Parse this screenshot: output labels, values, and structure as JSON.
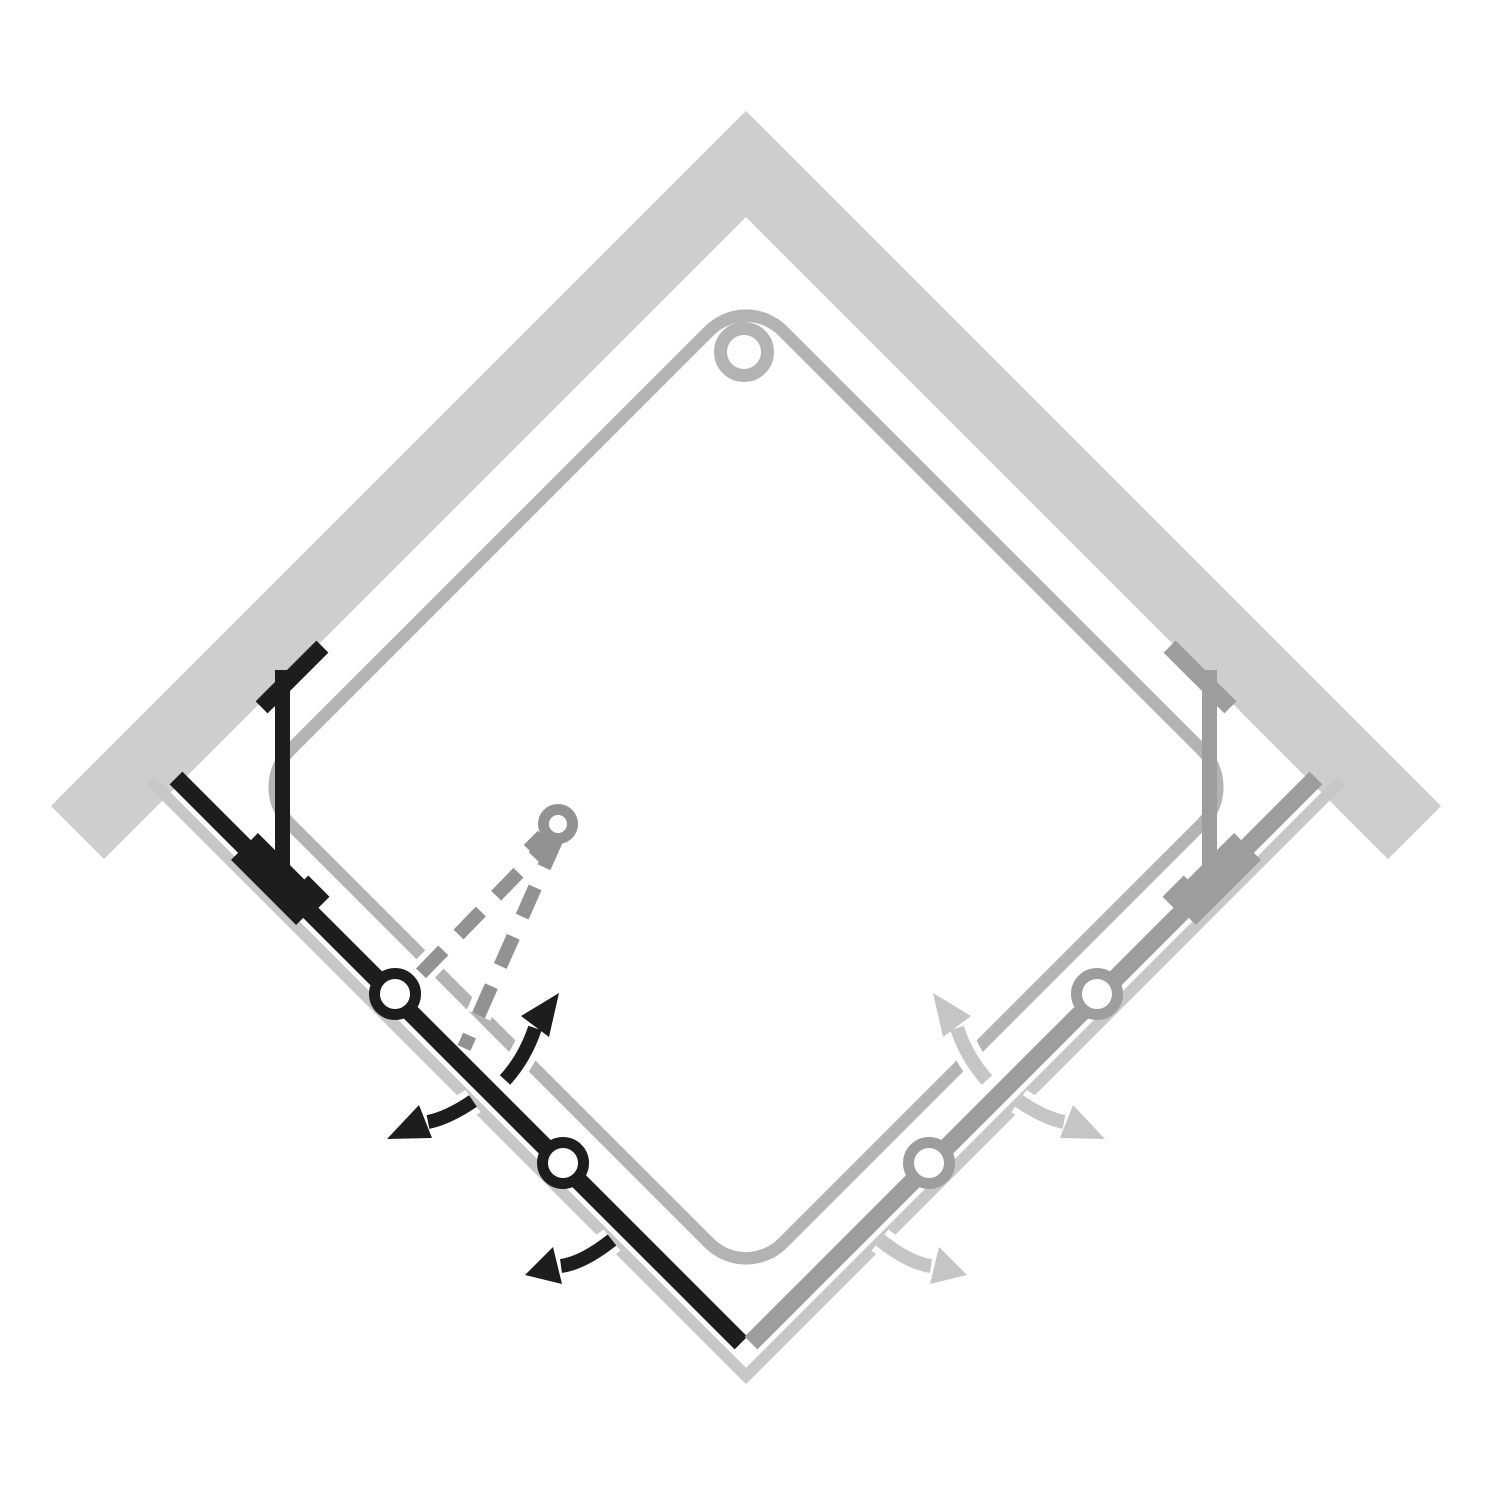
{
  "canvas": {
    "background": "#ffffff",
    "width_px": 1500,
    "height_px": 1500
  },
  "colors": {
    "background": "#ffffff",
    "wall": "#cecece",
    "tray_rim": "#b3b3b3",
    "tray_outer_edge": "#c7c7c7",
    "drain_ring": "#b3b3b3",
    "active_door": "#1d1d1b",
    "inactive_door": "#9d9d9d",
    "inactive_arrow": "#c5c5c5",
    "open_position": "#929292",
    "hinge_fill": "#ffffff"
  },
  "diagram": {
    "kind": "plan-view line diagram",
    "subject": "corner-entry shower enclosure with two bi-fold doors",
    "orientation": "rotated 45 degrees (diamond), corner of two walls at top",
    "walls": {
      "count": 2,
      "style": "solid light-gray band chevron"
    },
    "tray": {
      "shape": "rounded square (diamond orientation)",
      "outlines": 2,
      "circle_marker_count": 1
    },
    "left_door": {
      "emphasis": "active (solid black)",
      "hinge_count": 2,
      "swing_arrow_count": 3,
      "wall_bracket": true,
      "open_position_dashed_lines": 2,
      "open_position_pivot_circle": 1
    },
    "right_door": {
      "emphasis": "inactive (gray, mirrored)",
      "hinge_count": 2,
      "swing_arrow_count": 3,
      "wall_bracket": true,
      "open_position_dashed_lines": 0,
      "open_position_pivot_circle": 0
    }
  }
}
